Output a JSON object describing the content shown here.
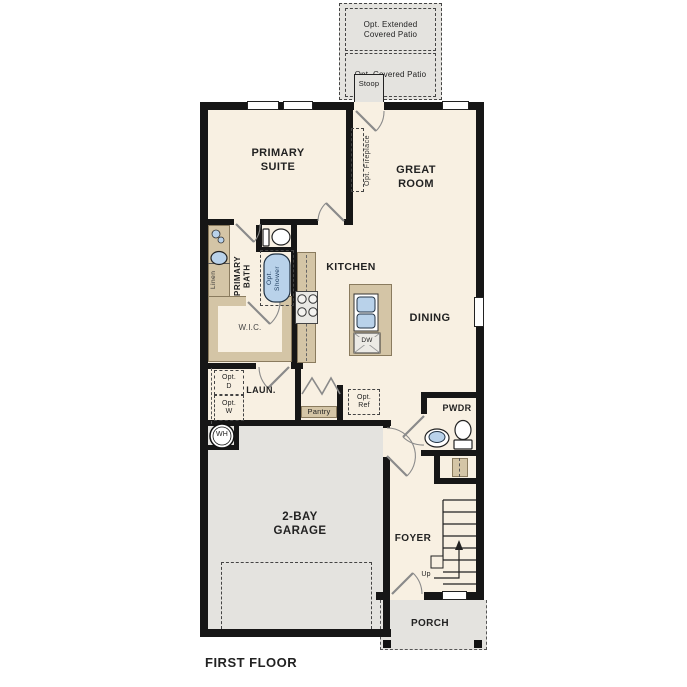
{
  "title": "FIRST FLOOR",
  "colors": {
    "floor": "#f8f0e2",
    "concrete": "#e4e3df",
    "wall": "#161616",
    "cabinet": "#d4c5a6",
    "fixture": "#b9d2ea",
    "dash": "#444444",
    "door": "#8a8a8a"
  },
  "labels": {
    "opt_extended_patio": "Opt. Extended\nCovered Patio",
    "opt_covered_patio": "Opt. Covered Patio",
    "stoop": "Stoop",
    "primary_suite": "PRIMARY\nSUITE",
    "great_room": "GREAT\nROOM",
    "opt_fireplace": "Opt. Fireplace",
    "primary_bath": "PRIMARY\nBATH",
    "opt_shower": "Opt.\nShower",
    "linen": "Linen",
    "wic": "W.I.C.",
    "kitchen": "KITCHEN",
    "dining": "DINING",
    "dw": "DW",
    "laundry": "LAUN.",
    "opt_dryer": "Opt.\nD",
    "opt_washer": "Opt.\nW",
    "pantry": "Pantry",
    "opt_ref": "Opt.\nRef",
    "water_heater": "WH",
    "pwdr": "PWDR",
    "garage": "2-BAY\nGARAGE",
    "foyer": "FOYER",
    "up": "Up",
    "porch": "PORCH",
    "first_floor": "FIRST FLOOR"
  }
}
